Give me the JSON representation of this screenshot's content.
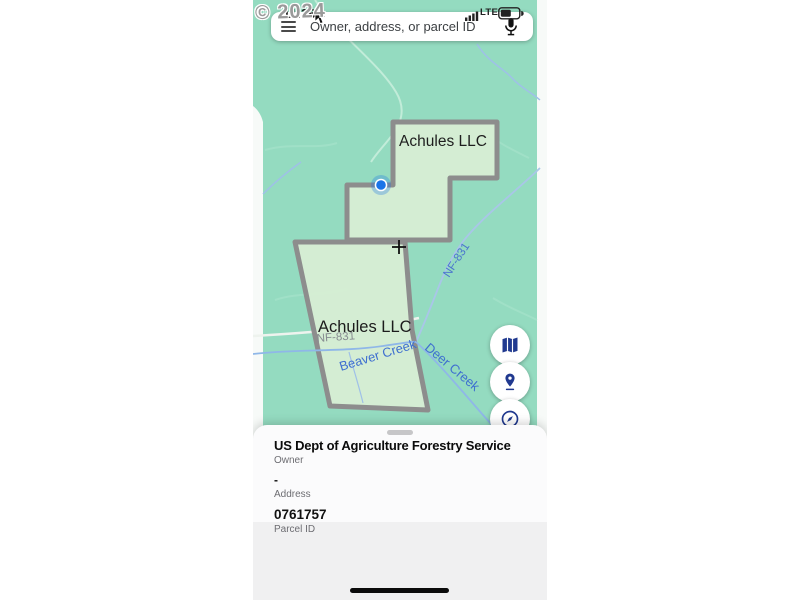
{
  "watermark": "© 2024",
  "status_bar": {
    "time": "11:36",
    "network": "LTE"
  },
  "search": {
    "placeholder": "Owner, address, or parcel ID"
  },
  "map": {
    "parcel_labels": [
      {
        "id": "north-parcel",
        "label": "Achules LLC"
      },
      {
        "id": "south-parcel",
        "label": "Achules LLC"
      }
    ],
    "road_labels": [
      {
        "id": "nf831-on-road",
        "label": "NF-831"
      },
      {
        "id": "nf831-along-route",
        "label": "NF-831"
      }
    ],
    "water_labels": [
      {
        "id": "beaver-creek",
        "label": "Beaver Creek"
      },
      {
        "id": "deer-creek",
        "label": "Deer Creek"
      }
    ]
  },
  "map_controls": {
    "icons": [
      "map-type-icon",
      "pin-drop-icon",
      "explore-icon"
    ]
  },
  "parcel_sheet": {
    "owner_value": "US Dept of Agriculture Forestry Service",
    "owner_label": "Owner",
    "address_value": "-",
    "address_label": "Address",
    "parcel_id_value": "0761757",
    "parcel_id_label": "Parcel ID"
  },
  "colors": {
    "map_green": "#94dbc0",
    "parcel_fill": "#d7eed4",
    "parcel_border": "#8d8d8d",
    "label_blue": "#3e6fd0",
    "location_blue": "#1a73e8",
    "control_icon_navy": "#20398f"
  }
}
